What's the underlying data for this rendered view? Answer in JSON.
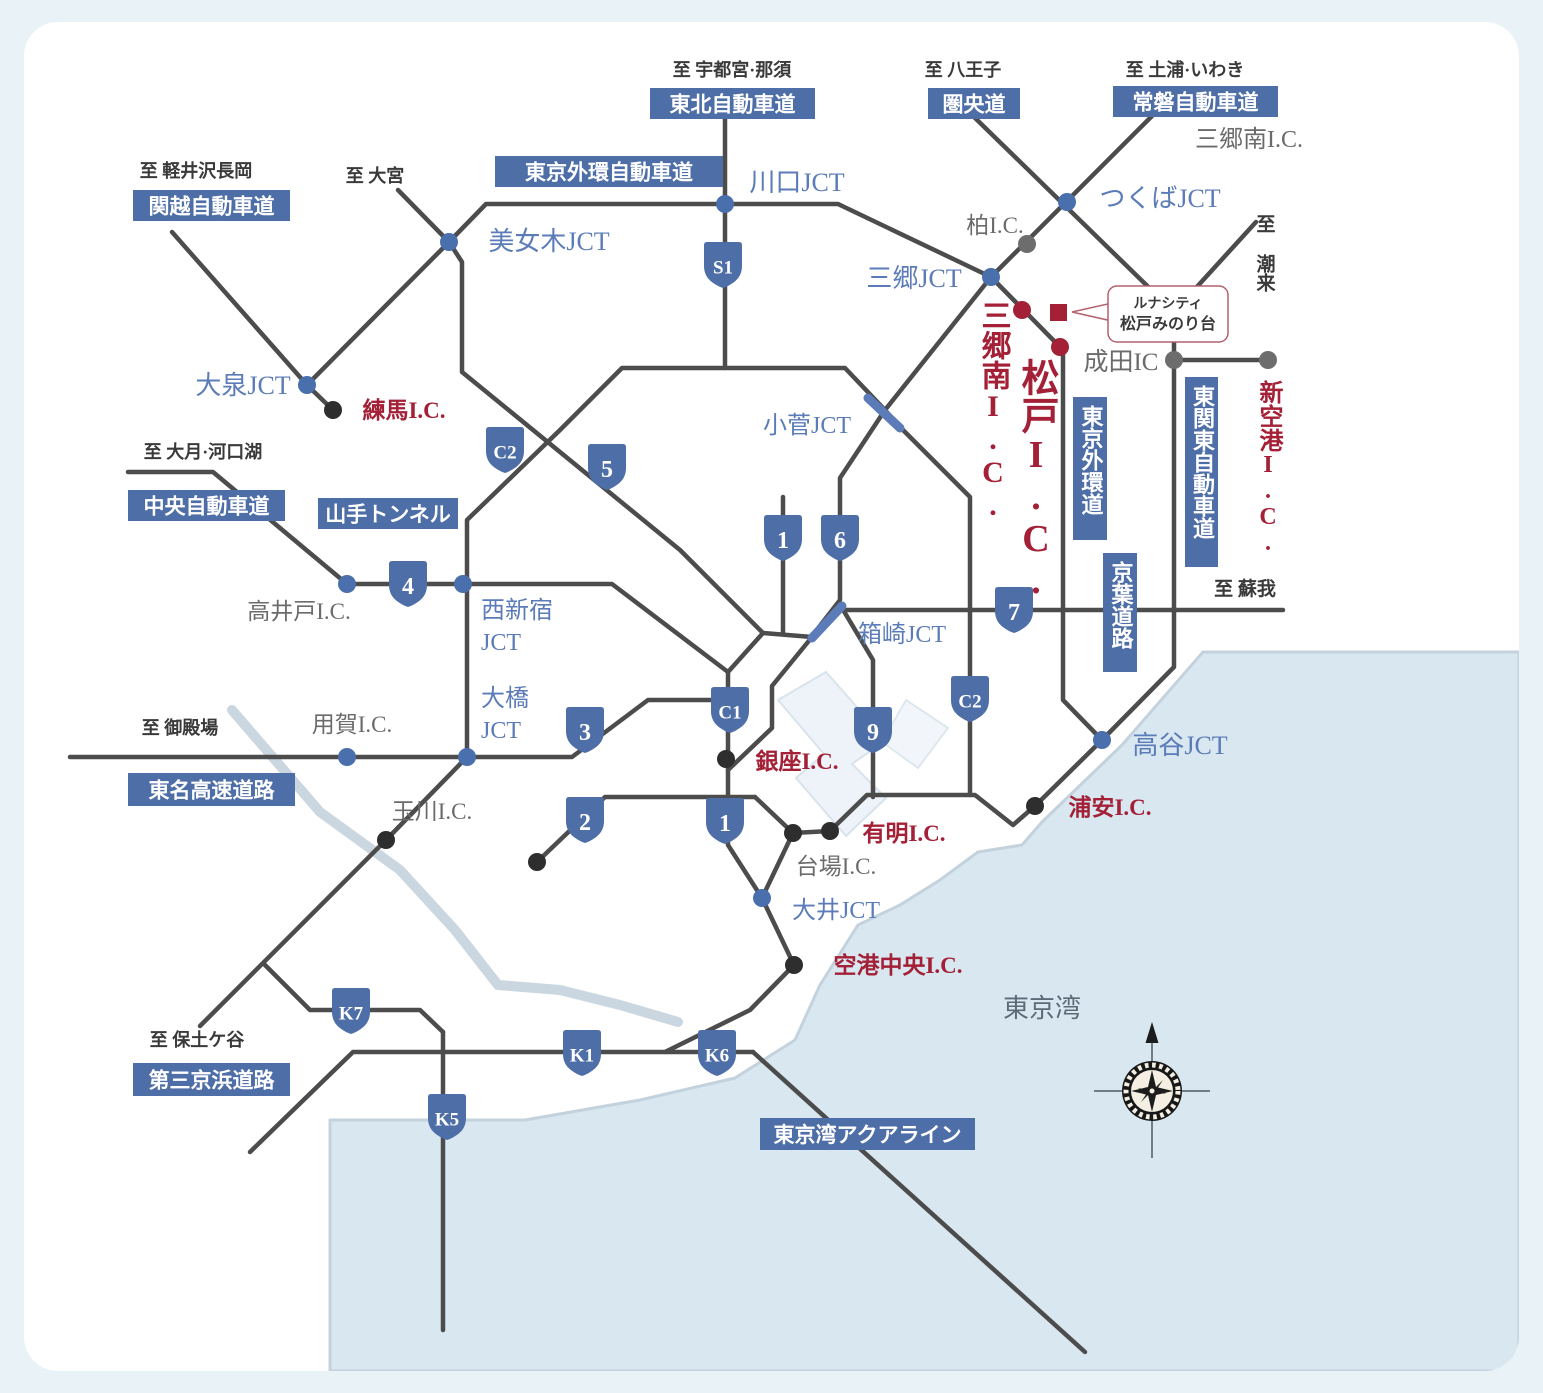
{
  "map_name": "首都圏高速道路アクセスマップ",
  "colors": {
    "page_background": "#e9f2f7",
    "card_background": "#ffffff",
    "badge_blue": "#4e6ea8",
    "jct_blue": "#5b7cb8",
    "red": "#a32036",
    "gray": "#6b6b6b",
    "dark": "#3a3a3a",
    "bay": "#5d6b79",
    "road": "#4c4c4c",
    "water": "#d9e7f1",
    "water_edge": "#c3d2dd",
    "river": "#cbd7e0",
    "node_blue": "#4a6fad",
    "node_gray": "#6d6d6d",
    "node_black": "#2e2e2e",
    "tunnel": "#5b7cb8",
    "land_pale": "#edf3f8",
    "callout_border": "#b4606e"
  },
  "sea_label": {
    "text": "東京湾"
  },
  "compass": {
    "icon": "compass-rose-icon",
    "direction": "north"
  },
  "landmark_callout": {
    "line1": "ルナシティ",
    "line2": "松戸みのり台"
  },
  "road_name_badges": [
    {
      "id": "tohoku-expwy",
      "text": "東北自動車道",
      "x": 650,
      "y": 88,
      "w": 165,
      "h": 31,
      "o": "h"
    },
    {
      "id": "kenodo",
      "text": "圏央道",
      "x": 928,
      "y": 88,
      "w": 92,
      "h": 31,
      "o": "h"
    },
    {
      "id": "joban-expwy",
      "text": "常磐自動車道",
      "x": 1113,
      "y": 86,
      "w": 165,
      "h": 31,
      "o": "h"
    },
    {
      "id": "kanetsu-expwy",
      "text": "関越自動車道",
      "x": 133,
      "y": 190,
      "w": 157,
      "h": 31,
      "o": "h"
    },
    {
      "id": "tokyo-gaikan-expwy",
      "text": "東京外環自動車道",
      "x": 495,
      "y": 156,
      "w": 228,
      "h": 31,
      "o": "h"
    },
    {
      "id": "chuo-expwy",
      "text": "中央自動車道",
      "x": 128,
      "y": 490,
      "w": 157,
      "h": 31,
      "o": "h"
    },
    {
      "id": "yamate-tunnel",
      "text": "山手トンネル",
      "x": 318,
      "y": 498,
      "w": 140,
      "h": 31,
      "o": "h"
    },
    {
      "id": "tomei-expwy",
      "text": "東名高速道路",
      "x": 128,
      "y": 773,
      "w": 167,
      "h": 33,
      "o": "h"
    },
    {
      "id": "daisan-keihin",
      "text": "第三京浜道路",
      "x": 133,
      "y": 1063,
      "w": 157,
      "h": 33,
      "o": "h"
    },
    {
      "id": "aqualine",
      "text": "東京湾アクアライン",
      "x": 760,
      "y": 1118,
      "w": 215,
      "h": 32,
      "o": "h"
    },
    {
      "id": "tokyo-gaikando",
      "text": "東京外環道",
      "x": 1073,
      "y": 397,
      "w": 34,
      "h": 143,
      "o": "v"
    },
    {
      "id": "higashi-kanto-expwy",
      "text": "東関東自動車道",
      "x": 1185,
      "y": 377,
      "w": 33,
      "h": 190,
      "o": "v"
    },
    {
      "id": "keiyo-road",
      "text": "京葉道路",
      "x": 1103,
      "y": 553,
      "w": 34,
      "h": 119,
      "o": "v"
    }
  ],
  "route_shields": [
    {
      "text": "S1",
      "x": 723,
      "y": 265
    },
    {
      "text": "C2",
      "x": 505,
      "y": 450
    },
    {
      "text": "5",
      "x": 607,
      "y": 467
    },
    {
      "text": "4",
      "x": 408,
      "y": 584
    },
    {
      "text": "1",
      "x": 783,
      "y": 538
    },
    {
      "text": "6",
      "x": 840,
      "y": 538
    },
    {
      "text": "7",
      "x": 1014,
      "y": 610
    },
    {
      "text": "C1",
      "x": 730,
      "y": 710
    },
    {
      "text": "C2",
      "x": 970,
      "y": 699
    },
    {
      "text": "9",
      "x": 873,
      "y": 730
    },
    {
      "text": "3",
      "x": 585,
      "y": 730
    },
    {
      "text": "2",
      "x": 585,
      "y": 820
    },
    {
      "text": "1",
      "x": 725,
      "y": 821
    },
    {
      "text": "K7",
      "x": 351,
      "y": 1011
    },
    {
      "text": "K1",
      "x": 582,
      "y": 1053
    },
    {
      "text": "K6",
      "x": 717,
      "y": 1053
    },
    {
      "text": "K5",
      "x": 447,
      "y": 1117
    }
  ],
  "labels": [
    {
      "t": "至 宇都宮·那須",
      "x": 732,
      "y": 76,
      "c": "dark",
      "s": 18,
      "w": 600
    },
    {
      "t": "至 八王子",
      "x": 963,
      "y": 76,
      "c": "dark",
      "s": 18,
      "w": 600
    },
    {
      "t": "至 土浦·いわき",
      "x": 1185,
      "y": 76,
      "c": "dark",
      "s": 18,
      "w": 600
    },
    {
      "t": "至 軽井沢長岡",
      "x": 196,
      "y": 177,
      "c": "dark",
      "s": 18,
      "w": 600
    },
    {
      "t": "至 大宮",
      "x": 375,
      "y": 182,
      "c": "dark",
      "s": 18,
      "w": 600
    },
    {
      "t": "至 大月·河口湖",
      "x": 203,
      "y": 458,
      "c": "dark",
      "s": 18,
      "w": 600
    },
    {
      "t": "至 御殿場",
      "x": 180,
      "y": 734,
      "c": "dark",
      "s": 18,
      "w": 600
    },
    {
      "t": "至 保土ケ谷",
      "x": 197,
      "y": 1046,
      "c": "dark",
      "s": 18,
      "w": 600
    },
    {
      "t": "至 蘇我",
      "x": 1245,
      "y": 595,
      "c": "dark",
      "s": 19,
      "w": 600
    },
    {
      "t": "至 潮来",
      "x": 1264,
      "y": 214,
      "c": "dark",
      "s": 19,
      "w": 600,
      "o": "v",
      "a": "start"
    },
    {
      "t": "川口JCT",
      "x": 797,
      "y": 191,
      "c": "blue",
      "s": 26
    },
    {
      "t": "美女木JCT",
      "x": 549,
      "y": 250,
      "c": "blue",
      "s": 26
    },
    {
      "t": "つくばJCT",
      "x": 1160,
      "y": 207,
      "c": "blue",
      "s": 26
    },
    {
      "t": "三郷JCT",
      "x": 914,
      "y": 287,
      "c": "blue",
      "s": 26
    },
    {
      "t": "大泉JCT",
      "x": 243,
      "y": 394,
      "c": "blue",
      "s": 26
    },
    {
      "t": "小菅JCT",
      "x": 807,
      "y": 433,
      "c": "blue",
      "s": 24
    },
    {
      "t": "箱崎JCT",
      "x": 902,
      "y": 642,
      "c": "blue",
      "s": 24
    },
    {
      "t": "大井JCT",
      "x": 836,
      "y": 918,
      "c": "blue",
      "s": 24
    },
    {
      "t": "高谷JCT",
      "x": 1180,
      "y": 754,
      "c": "blue",
      "s": 26
    },
    {
      "t": "西新宿",
      "x": 481,
      "y": 618,
      "c": "blue",
      "s": 24,
      "a": "start"
    },
    {
      "t": "JCT",
      "x": 481,
      "y": 650,
      "c": "blue",
      "s": 24,
      "a": "start"
    },
    {
      "t": "大橋",
      "x": 481,
      "y": 706,
      "c": "blue",
      "s": 24,
      "a": "start"
    },
    {
      "t": "JCT",
      "x": 481,
      "y": 738,
      "c": "blue",
      "s": 24,
      "a": "start"
    },
    {
      "t": "練馬I.C.",
      "x": 404,
      "y": 418,
      "c": "red",
      "s": 23,
      "w": 700
    },
    {
      "t": "銀座I.C.",
      "x": 797,
      "y": 769,
      "c": "red",
      "s": 23,
      "w": 700
    },
    {
      "t": "有明I.C.",
      "x": 904,
      "y": 841,
      "c": "red",
      "s": 23,
      "w": 700
    },
    {
      "t": "空港中央I.C.",
      "x": 898,
      "y": 973,
      "c": "red",
      "s": 23,
      "w": 700
    },
    {
      "t": "浦安I.C.",
      "x": 1110,
      "y": 815,
      "c": "red",
      "s": 23,
      "w": 700
    },
    {
      "t": "新空港I.C.",
      "x": 1268,
      "y": 380,
      "c": "red",
      "s": 24,
      "w": 700,
      "o": "v",
      "a": "start"
    },
    {
      "t": "三郷南I.C.",
      "x": 993,
      "y": 300,
      "c": "red",
      "s": 30,
      "w": 800,
      "o": "v",
      "a": "start"
    },
    {
      "t": "松戸I.C.",
      "x": 1036,
      "y": 358,
      "c": "red",
      "s": 38,
      "w": 800,
      "o": "v",
      "a": "start"
    },
    {
      "t": "柏I.C.",
      "x": 995,
      "y": 233,
      "c": "gray",
      "s": 23
    },
    {
      "t": "三郷南I.C.",
      "x": 1249,
      "y": 147,
      "c": "gray",
      "s": 24
    },
    {
      "t": "成田IC",
      "x": 1121,
      "y": 370,
      "c": "gray",
      "s": 25
    },
    {
      "t": "高井戸I.C.",
      "x": 299,
      "y": 619,
      "c": "gray",
      "s": 23
    },
    {
      "t": "用賀I.C.",
      "x": 352,
      "y": 732,
      "c": "gray",
      "s": 23
    },
    {
      "t": "玉川I.C.",
      "x": 432,
      "y": 819,
      "c": "gray",
      "s": 23
    },
    {
      "t": "台場I.C.",
      "x": 836,
      "y": 874,
      "c": "gray",
      "s": 23
    }
  ],
  "nodes": [
    {
      "x": 725,
      "y": 204,
      "c": "blue"
    },
    {
      "x": 449,
      "y": 242,
      "c": "blue"
    },
    {
      "x": 307,
      "y": 385,
      "c": "blue"
    },
    {
      "x": 1067,
      "y": 202,
      "c": "blue"
    },
    {
      "x": 991,
      "y": 277,
      "c": "blue"
    },
    {
      "x": 347,
      "y": 584,
      "c": "blue"
    },
    {
      "x": 463,
      "y": 584,
      "c": "blue"
    },
    {
      "x": 347,
      "y": 757,
      "c": "blue"
    },
    {
      "x": 467,
      "y": 757,
      "c": "blue"
    },
    {
      "x": 762,
      "y": 898,
      "c": "blue"
    },
    {
      "x": 1102,
      "y": 740,
      "c": "blue"
    },
    {
      "x": 1027,
      "y": 244,
      "c": "gray"
    },
    {
      "x": 1174,
      "y": 360,
      "c": "gray"
    },
    {
      "x": 1268,
      "y": 360,
      "c": "gray"
    },
    {
      "x": 333,
      "y": 410,
      "c": "black"
    },
    {
      "x": 386,
      "y": 840,
      "c": "black"
    },
    {
      "x": 537,
      "y": 862,
      "c": "black"
    },
    {
      "x": 726,
      "y": 759,
      "c": "black"
    },
    {
      "x": 793,
      "y": 833,
      "c": "black"
    },
    {
      "x": 830,
      "y": 831,
      "c": "black"
    },
    {
      "x": 794,
      "y": 965,
      "c": "black"
    },
    {
      "x": 1035,
      "y": 806,
      "c": "black"
    },
    {
      "x": 1022,
      "y": 310,
      "c": "red"
    },
    {
      "x": 1060,
      "y": 347,
      "c": "red"
    }
  ],
  "tunnel_segments": [
    {
      "x1": 868,
      "y1": 398,
      "x2": 900,
      "y2": 428
    },
    {
      "x1": 812,
      "y1": 638,
      "x2": 842,
      "y2": 606
    }
  ],
  "landmark_marker": {
    "x": 1050,
    "y": 304,
    "size": 17
  }
}
